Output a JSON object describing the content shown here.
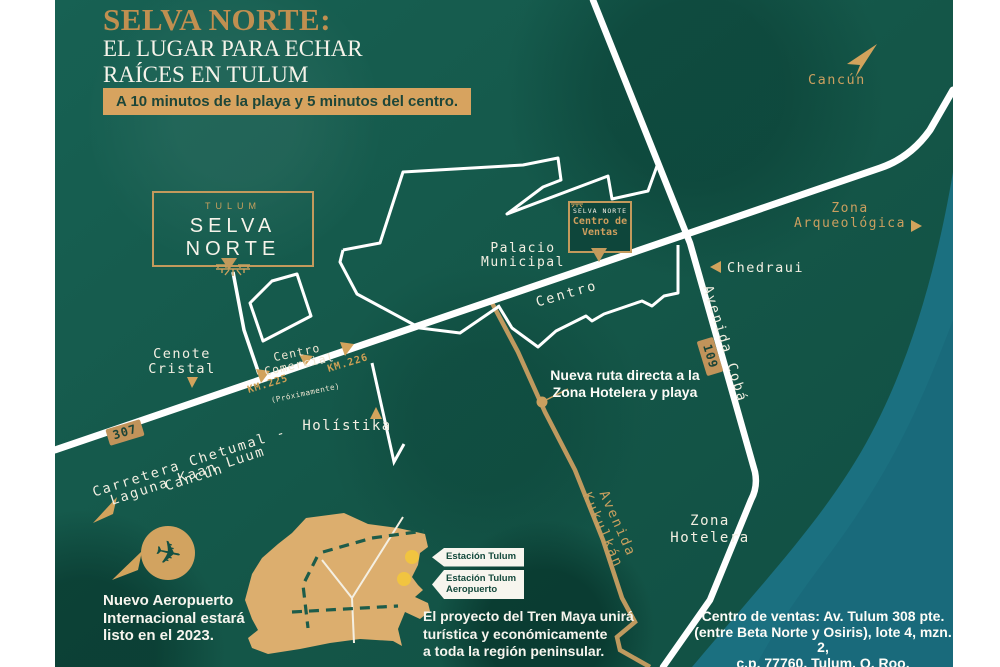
{
  "header": {
    "title_accent": "SELVA NORTE:",
    "title_rest": "EL LUGAR PARA ECHAR\nRAÍCES EN TULUM",
    "badge": "A 10 minutos de la playa y 5 minutos del centro."
  },
  "logo": {
    "city": "TULUM",
    "name": "SELVA NORTE"
  },
  "sales_box": {
    "brand": "SELVA NORTE",
    "label": "Centro de\nVentas"
  },
  "roads": {
    "highway_name": "Carretera Chetumal - Cancún",
    "highway_shield": "307",
    "km225": "KM.225",
    "km226": "KM.226",
    "coba_name": "Avenida Cobá",
    "coba_shield": "109",
    "kukulkan_name": "Avenida Kukulkán",
    "centro_street": "Centro"
  },
  "places": {
    "cancun": "Cancún",
    "zona_arqueologica": "Zona\nArqueológica",
    "chedraui": "Chedraui",
    "palacio": "Palacio\nMunicipal",
    "cenote": "Cenote\nCristal",
    "centro_comercial": "Centro\nComercial",
    "proximamente": "(Próximamente)",
    "holistika": "Holístika",
    "laguna": "Laguna Kaan Luum",
    "zona_hotelera": "Zona\nHotelera"
  },
  "callouts": {
    "nueva_ruta": "Nueva ruta directa a la\nZona Hotelera y playa",
    "aeropuerto": "Nuevo Aeropuerto\nInternacional estará\nlisto en el 2023.",
    "tren_maya": "El proyecto del Tren Maya unirá\nturística y económicamente\na toda la región peninsular.",
    "estacion_tulum": "Estación Tulum",
    "estacion_aeropuerto": "Estación Tulum\nAeropuerto",
    "address": "Centro de ventas: Av. Tulum 308 pte.\n(entre Beta Norte y Osiris), lote 4, mzn. 2,\nc.p. 77760, Tulum, Q. Roo."
  },
  "colors": {
    "jungle_green": "#15594b",
    "ocean_teal": "#1b7080",
    "gold": "#c89a5d",
    "sand": "#dcae6e"
  }
}
